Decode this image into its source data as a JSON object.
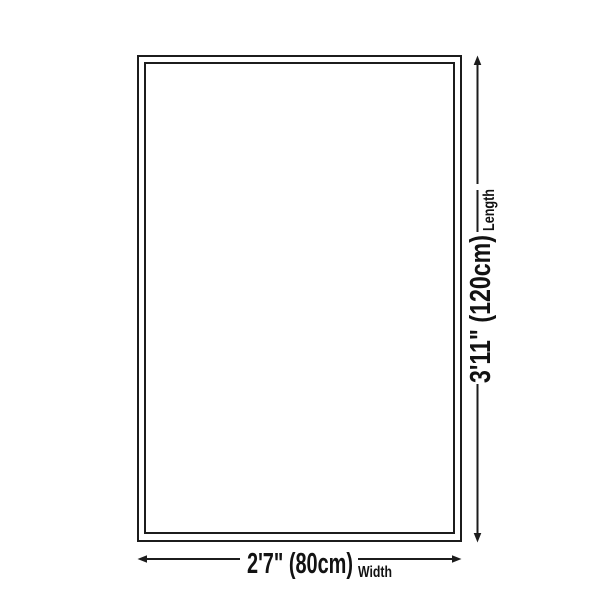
{
  "diagram": {
    "title": "rug-size-diagram",
    "width_dimension": {
      "value": "2'7\" (80cm)",
      "label": "Width"
    },
    "length_dimension": {
      "value": "3'11\" (120cm)",
      "label": "Length"
    },
    "colors": {
      "background": "#ffffff",
      "line": "#1c1c1c",
      "text": "#121212"
    }
  }
}
